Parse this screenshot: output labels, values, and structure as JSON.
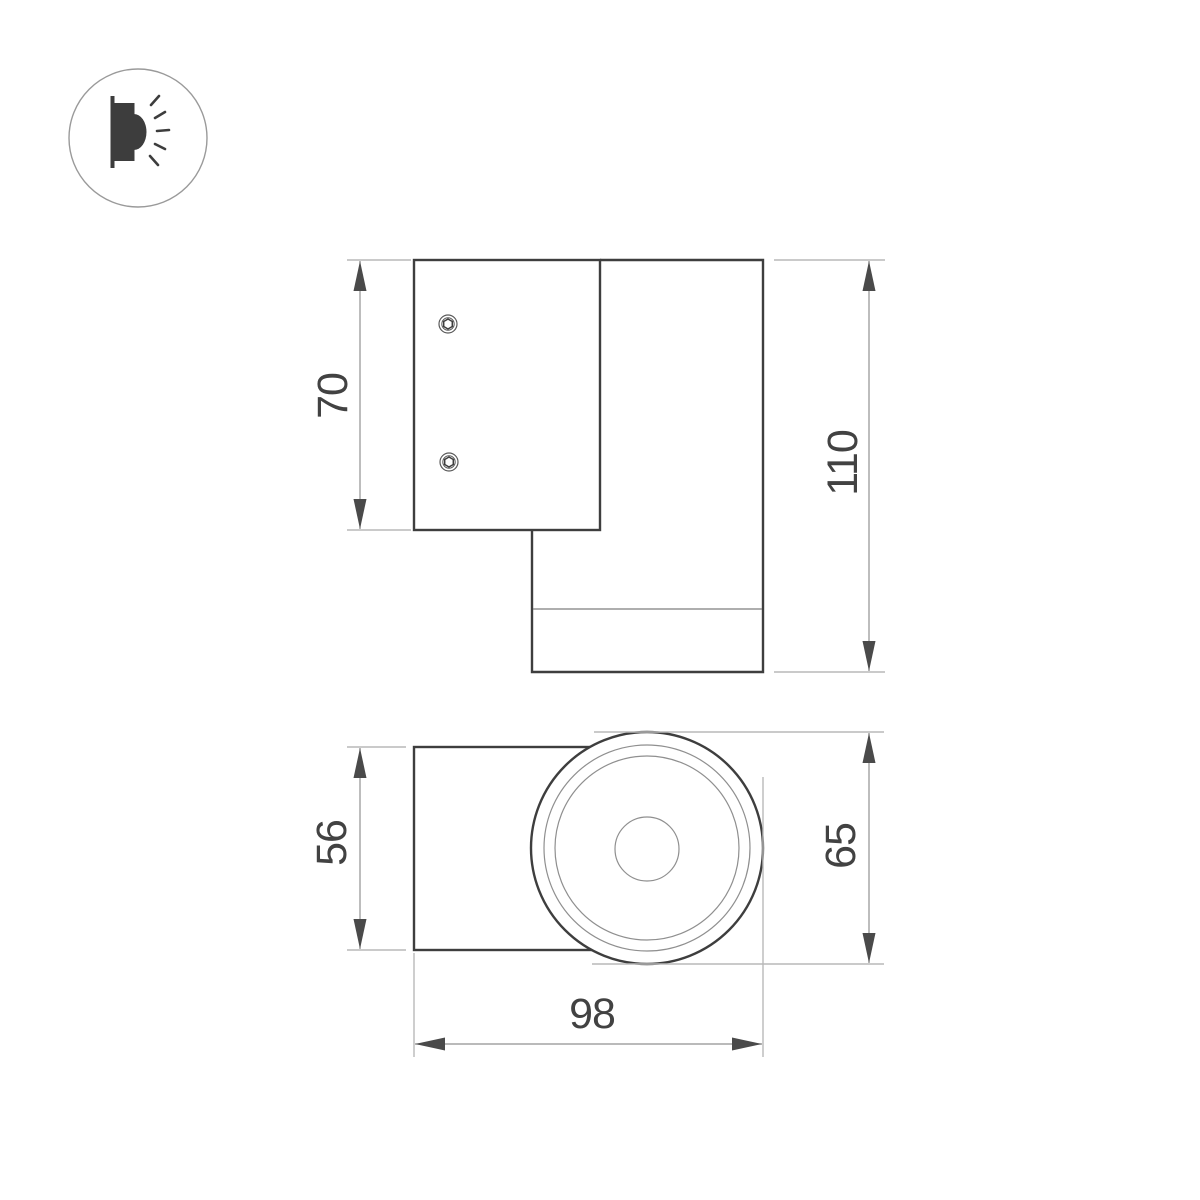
{
  "colors": {
    "background": "#ffffff",
    "outline": "#3e3e3e",
    "thin_detail": "#7e7e7e",
    "dimension_line": "#919191",
    "extension_line": "#b9b9b9",
    "arrowhead": "#4a4a4a",
    "dimension_text": "#424242"
  },
  "logo": {
    "icon": "wall-light-icon"
  },
  "views": [
    {
      "name": "side-view",
      "dimensions": [
        {
          "label": "70",
          "orientation": "vertical"
        },
        {
          "label": "110",
          "orientation": "vertical"
        }
      ]
    },
    {
      "name": "front-view",
      "dimensions": [
        {
          "label": "56",
          "orientation": "vertical"
        },
        {
          "label": "65",
          "orientation": "vertical"
        },
        {
          "label": "98",
          "orientation": "horizontal"
        }
      ]
    }
  ]
}
